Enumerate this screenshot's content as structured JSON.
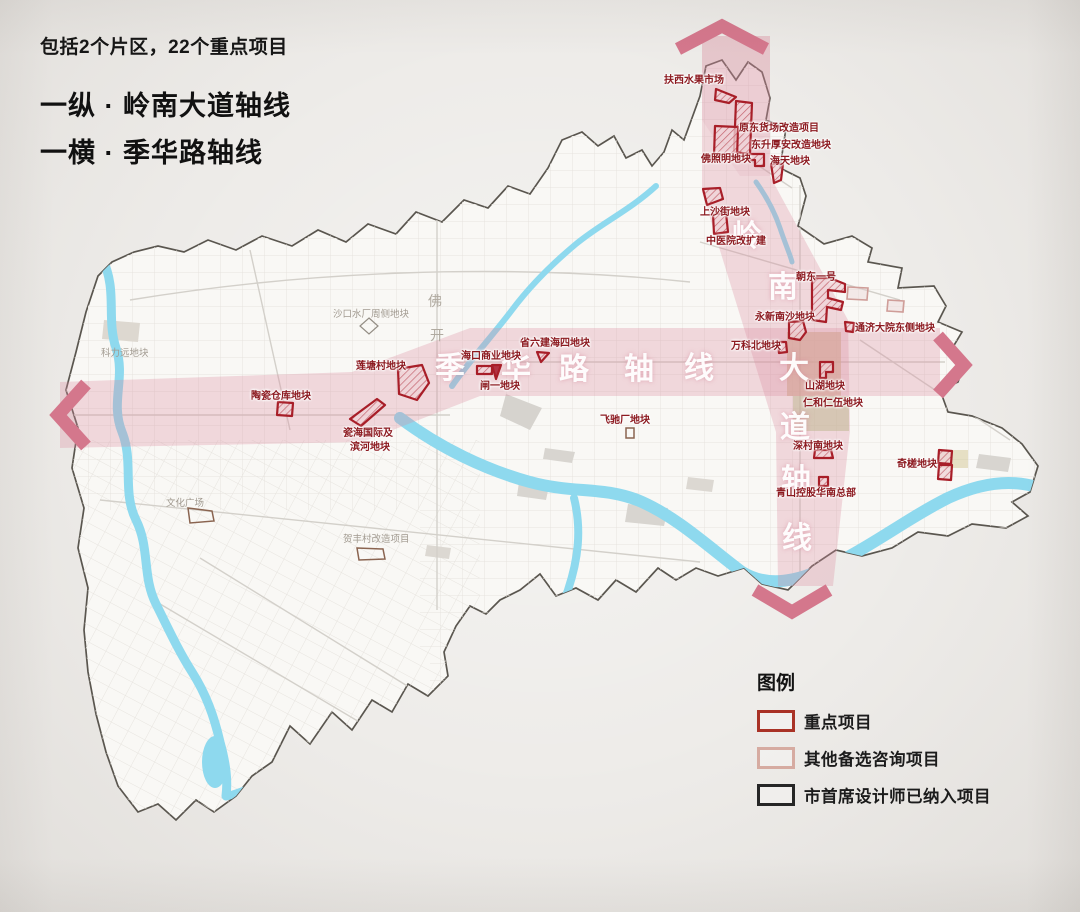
{
  "title": {
    "subtitle": "包括2个片区，22个重点项目",
    "line1": "一纵 · 岭南大道轴线",
    "line2": "一横 · 季华路轴线"
  },
  "axes": {
    "horizontal": {
      "name": "季华路轴线",
      "chars": [
        "季",
        "华",
        "路",
        "轴",
        "线"
      ]
    },
    "vertical": {
      "name": "岭南大道轴线",
      "chars": [
        "岭",
        "南",
        "大",
        "道",
        "轴",
        "线"
      ]
    },
    "band_color": "#d98b9e",
    "arrow_color": "#d4778c"
  },
  "projects": {
    "fuxi": "扶西水果市场",
    "yuandong": "原东货场改造项目",
    "dongsheng": "东升厚安改造地块",
    "fozhaoming": "佛照明地块",
    "haitian": "海天地块",
    "shangsha": "上沙街地块",
    "zhongyiyuan": "中医院改扩建",
    "chaodong": "朝东一号",
    "yongxin": "永新南沙地块",
    "tongji": "通济大院东侧地块",
    "wanke": "万科北地块",
    "shanhu": "山湖地块",
    "renhe": "仁和仁伍地块",
    "shencun": "深村南地块",
    "qingshan": "青山控股华南总部",
    "qicha": "奇槎地块",
    "shengliujian": "省六建海四地块",
    "haikou": "海口商业地块",
    "zhayi": "闸一地块",
    "liantang": "莲塘村地块",
    "taoci": "陶瓷仓库地块",
    "cihai_line1": "瓷海国际及",
    "cihai_line2": "滨河地块",
    "feichi": "飞驰厂地块"
  },
  "background_labels": {
    "shakou": "沙口水厂周侧地块",
    "keliyuan": "科力远地块",
    "wenhua": "文化广场",
    "hefeng": "贺丰村改造项目",
    "fo": "佛",
    "kai": "开"
  },
  "legend": {
    "title": "图例",
    "items": [
      {
        "label": "重点项目",
        "color": "#a93226"
      },
      {
        "label": "其他备选咨询项目",
        "color": "#d6aba1"
      },
      {
        "label": "市首席设计师已纳入项目",
        "color": "#262626"
      }
    ]
  },
  "colors": {
    "key_project_outline": "#a81e28",
    "river": "#8ed9ee",
    "boundary": "#5a564f"
  }
}
